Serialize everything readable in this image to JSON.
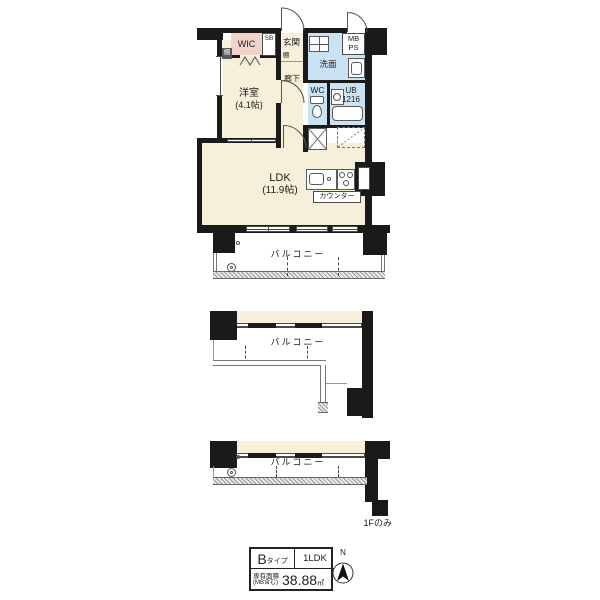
{
  "colors": {
    "wall": "#1a1a1a",
    "room": "#f6efd9",
    "wet": "#c9e3f2",
    "wic": "#f2d2ca",
    "rail": "#777777",
    "hatch": "#9a9a9a"
  },
  "unit": {
    "wic_label": "WIC",
    "sb_label": "SB",
    "genkan_label": "玄関",
    "shelf_wic_label": "棚",
    "shelf_hall_label": "棚",
    "senmen_label": "洗面",
    "mb_label": "MB",
    "ps_label": "PS",
    "hall_label": "廊下",
    "wc_label": "WC",
    "ub_label": "UB",
    "ub_size": "1216",
    "bedroom_name": "洋室",
    "bedroom_size": "(4.1帖)",
    "ldk_name": "LDK",
    "ldk_size": "(11.9帖)",
    "counter_label": "カウンター"
  },
  "balconies": {
    "top_label": "バルコニー",
    "middle_label": "バルコニー",
    "bottom_label": "バルコニー",
    "bottom_note": "1Fのみ"
  },
  "info_table": {
    "type_letter": "B",
    "type_suffix": "タイプ",
    "layout": "1LDK",
    "area_label": "専有面積",
    "area_label_sub": "(MB含む)",
    "area_value": "38.88",
    "area_unit": "㎡"
  },
  "compass": {
    "north": "N"
  }
}
